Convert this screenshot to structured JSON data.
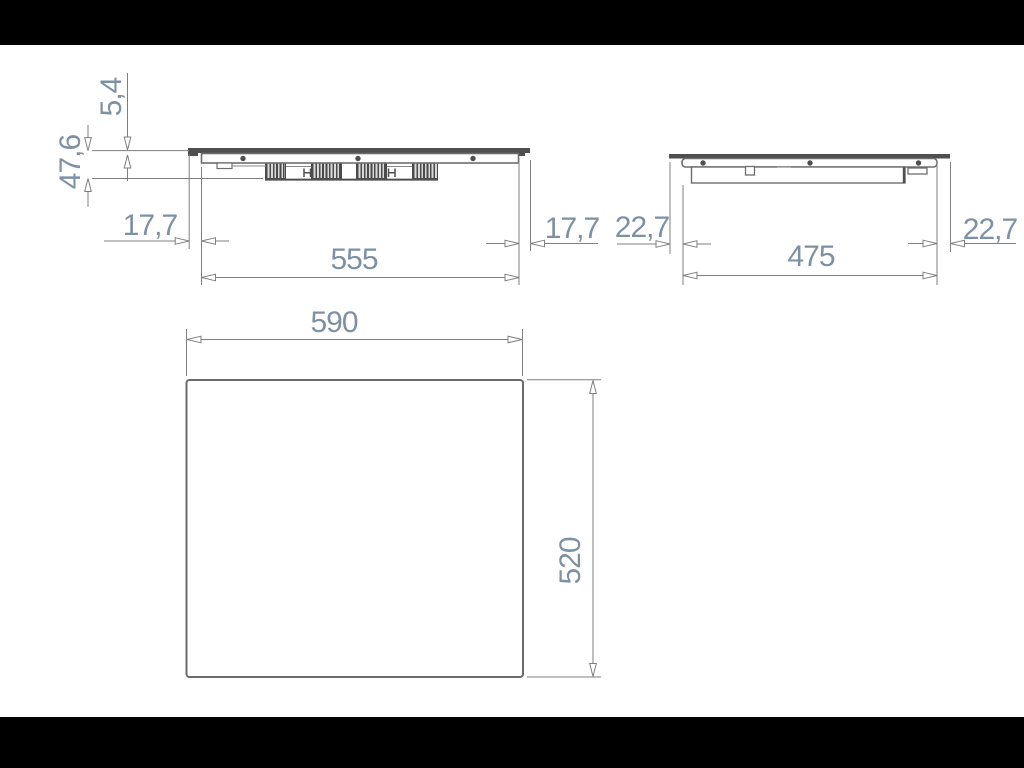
{
  "front_section_view": {
    "glass_height": "5,4",
    "total_height": "47,6",
    "overhang_left": "17,7",
    "body_width": "555",
    "overhang_right": "17,7"
  },
  "side_section_view": {
    "overhang_left": "22,7",
    "body_depth": "475",
    "overhang_right": "22,7"
  },
  "top_view": {
    "width": "590",
    "depth": "520"
  },
  "colors": {
    "dimension_text": "#7e91a4",
    "dimension_line": "#7f7f7f",
    "part_outline": "#6e6e6e",
    "dark_fill": "#4f4f4f",
    "letterbox": "#000000",
    "background": "#ffffff"
  }
}
